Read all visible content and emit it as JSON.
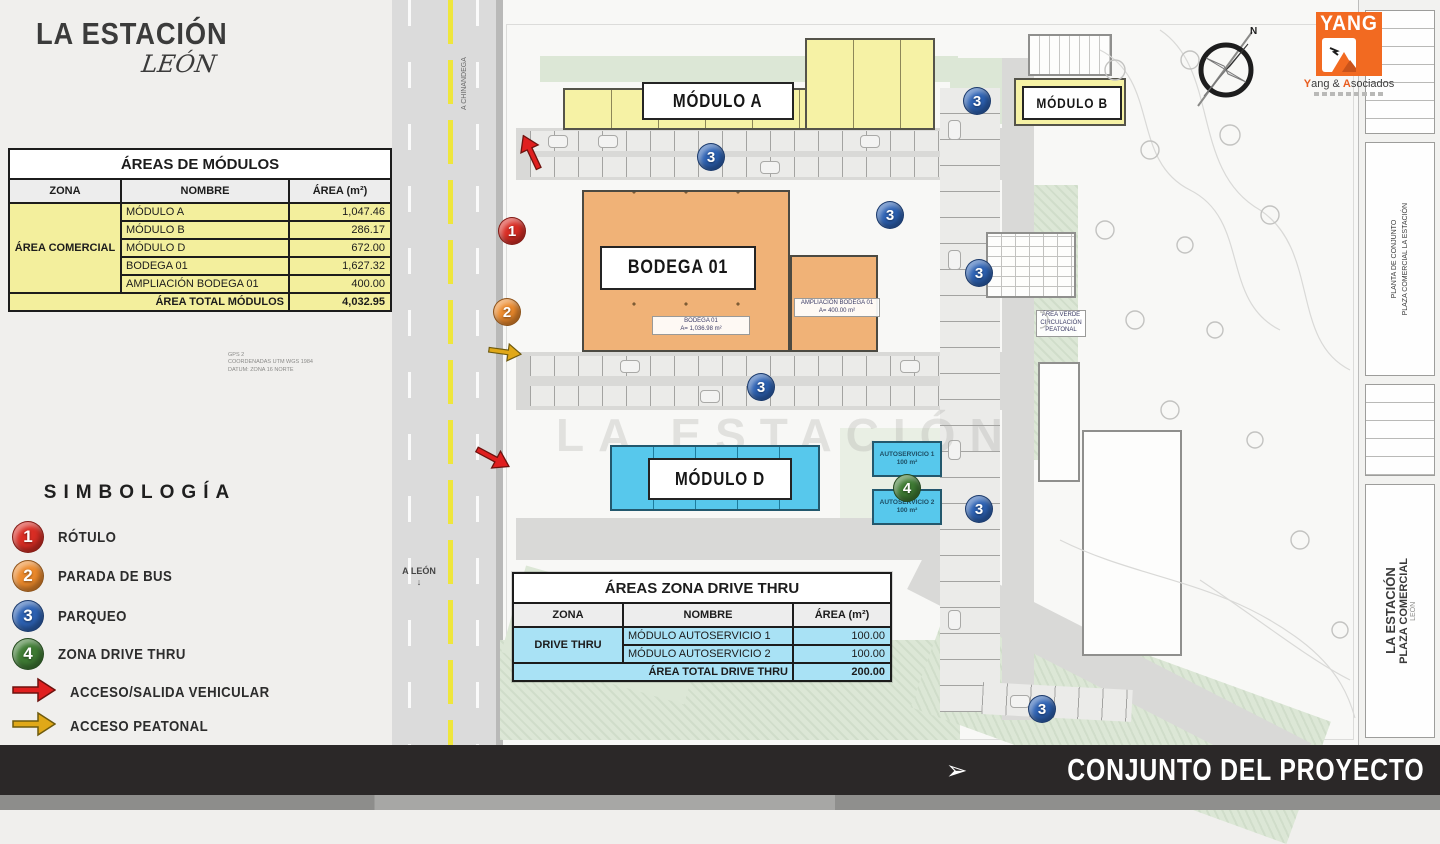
{
  "brand": {
    "title": "LA ESTACIÓN",
    "subtitle": "LEÓN"
  },
  "modules_table": {
    "title": "ÁREAS DE MÓDULOS",
    "col_zona": "ZONA",
    "col_nombre": "NOMBRE",
    "col_area": "ÁREA (m²)",
    "zone": "ÁREA COMERCIAL",
    "rows": [
      {
        "name": "MÓDULO A",
        "area": "1,047.46"
      },
      {
        "name": "MÓDULO B",
        "area": "286.17"
      },
      {
        "name": "MÓDULO D",
        "area": "672.00"
      },
      {
        "name": "BODEGA 01",
        "area": "1,627.32"
      },
      {
        "name": "AMPLIACIÓN BODEGA 01",
        "area": "400.00"
      }
    ],
    "total_label": "ÁREA TOTAL MÓDULOS",
    "total": "4,032.95"
  },
  "symbology": {
    "title": "SIMBOLOGÍA",
    "items": [
      {
        "num": "1",
        "label": "RÓTULO",
        "color": "#d92d24",
        "shape": "circle"
      },
      {
        "num": "2",
        "label": "PARADA DE BUS",
        "color": "#ec8a2c",
        "shape": "circle"
      },
      {
        "num": "3",
        "label": "PARQUEO",
        "color": "#2d62b4",
        "shape": "circle"
      },
      {
        "num": "4",
        "label": "ZONA DRIVE THRU",
        "color": "#3f7c34",
        "shape": "circle"
      },
      {
        "label": "ACCESO/SALIDA VEHICULAR",
        "color": "#e01f1f",
        "shape": "arrow"
      },
      {
        "label": "ACCESO PEATONAL",
        "color": "#e0a818",
        "shape": "arrow"
      }
    ]
  },
  "drive_table": {
    "title": "ÁREAS ZONA DRIVE THRU",
    "col_zona": "ZONA",
    "col_nombre": "NOMBRE",
    "col_area": "ÁREA (m²)",
    "zone": "DRIVE THRU",
    "rows": [
      {
        "name": "MÓDULO AUTOSERVICIO 1",
        "area": "100.00"
      },
      {
        "name": "MÓDULO AUTOSERVICIO 2",
        "area": "100.00"
      }
    ],
    "total_label": "ÁREA TOTAL DRIVE THRU",
    "total": "200.00"
  },
  "plan": {
    "modulo_a": "MÓDULO A",
    "modulo_b": "MÓDULO B",
    "modulo_d": "MÓDULO D",
    "bodega": "BODEGA 01",
    "bodega_area_line1": "BODEGA 01",
    "bodega_area_line2": "A= 1,036.98 m²",
    "ampliacion_line1": "AMPLIACIÓN BODEGA 01",
    "ampliacion_line2": "A= 400.00 m²",
    "auto1_line1": "AUTOSERVICIO 1",
    "auto1_line2": "100 m²",
    "auto2_line1": "AUTOSERVICIO 2",
    "auto2_line2": "100 m²",
    "green_label_line1": "ÁREA VERDE",
    "green_label_line2": "CIRCULACIÓN PEATONAL",
    "road_south": "A LEÓN",
    "road_south_arrow": "↓",
    "road_north": "A CHINANDEGA",
    "road_north_arrow": "↑",
    "marker1": "1",
    "marker2": "2",
    "marker3": "3",
    "marker4": "4",
    "gps_line1": "GPS 2",
    "gps_line2": "COORDENADAS UTM WGS 1984",
    "gps_line3": "DATUM: ZONA 16 NORTE",
    "watermark": "LA ESTACIÓN",
    "compass_n": "N"
  },
  "logo": {
    "yang": "YANG",
    "firm_html_y": "Y",
    "firm_mid": "ang & ",
    "firm_html_a": "A",
    "firm_end": "sociados"
  },
  "titleblock": {
    "project": "LA ESTACIÓN",
    "subtitle": "PLAZA COMERCIAL",
    "location": "LEÓN",
    "sheet_line1": "PLANTA DE CONJUNTO",
    "sheet_line2": "PLAZA COMERCIAL LA ESTACIÓN"
  },
  "footer": {
    "title": "CONJUNTO DEL PROYECTO",
    "arrow": "➢"
  },
  "colors": {
    "accent_orange": "#f26a21",
    "building_yellow": "#f6f2a5",
    "building_orange": "#f0b277",
    "building_cyan": "#57c8ec",
    "footer_bg": "#2b2828",
    "road_yellow": "#efe63c"
  }
}
